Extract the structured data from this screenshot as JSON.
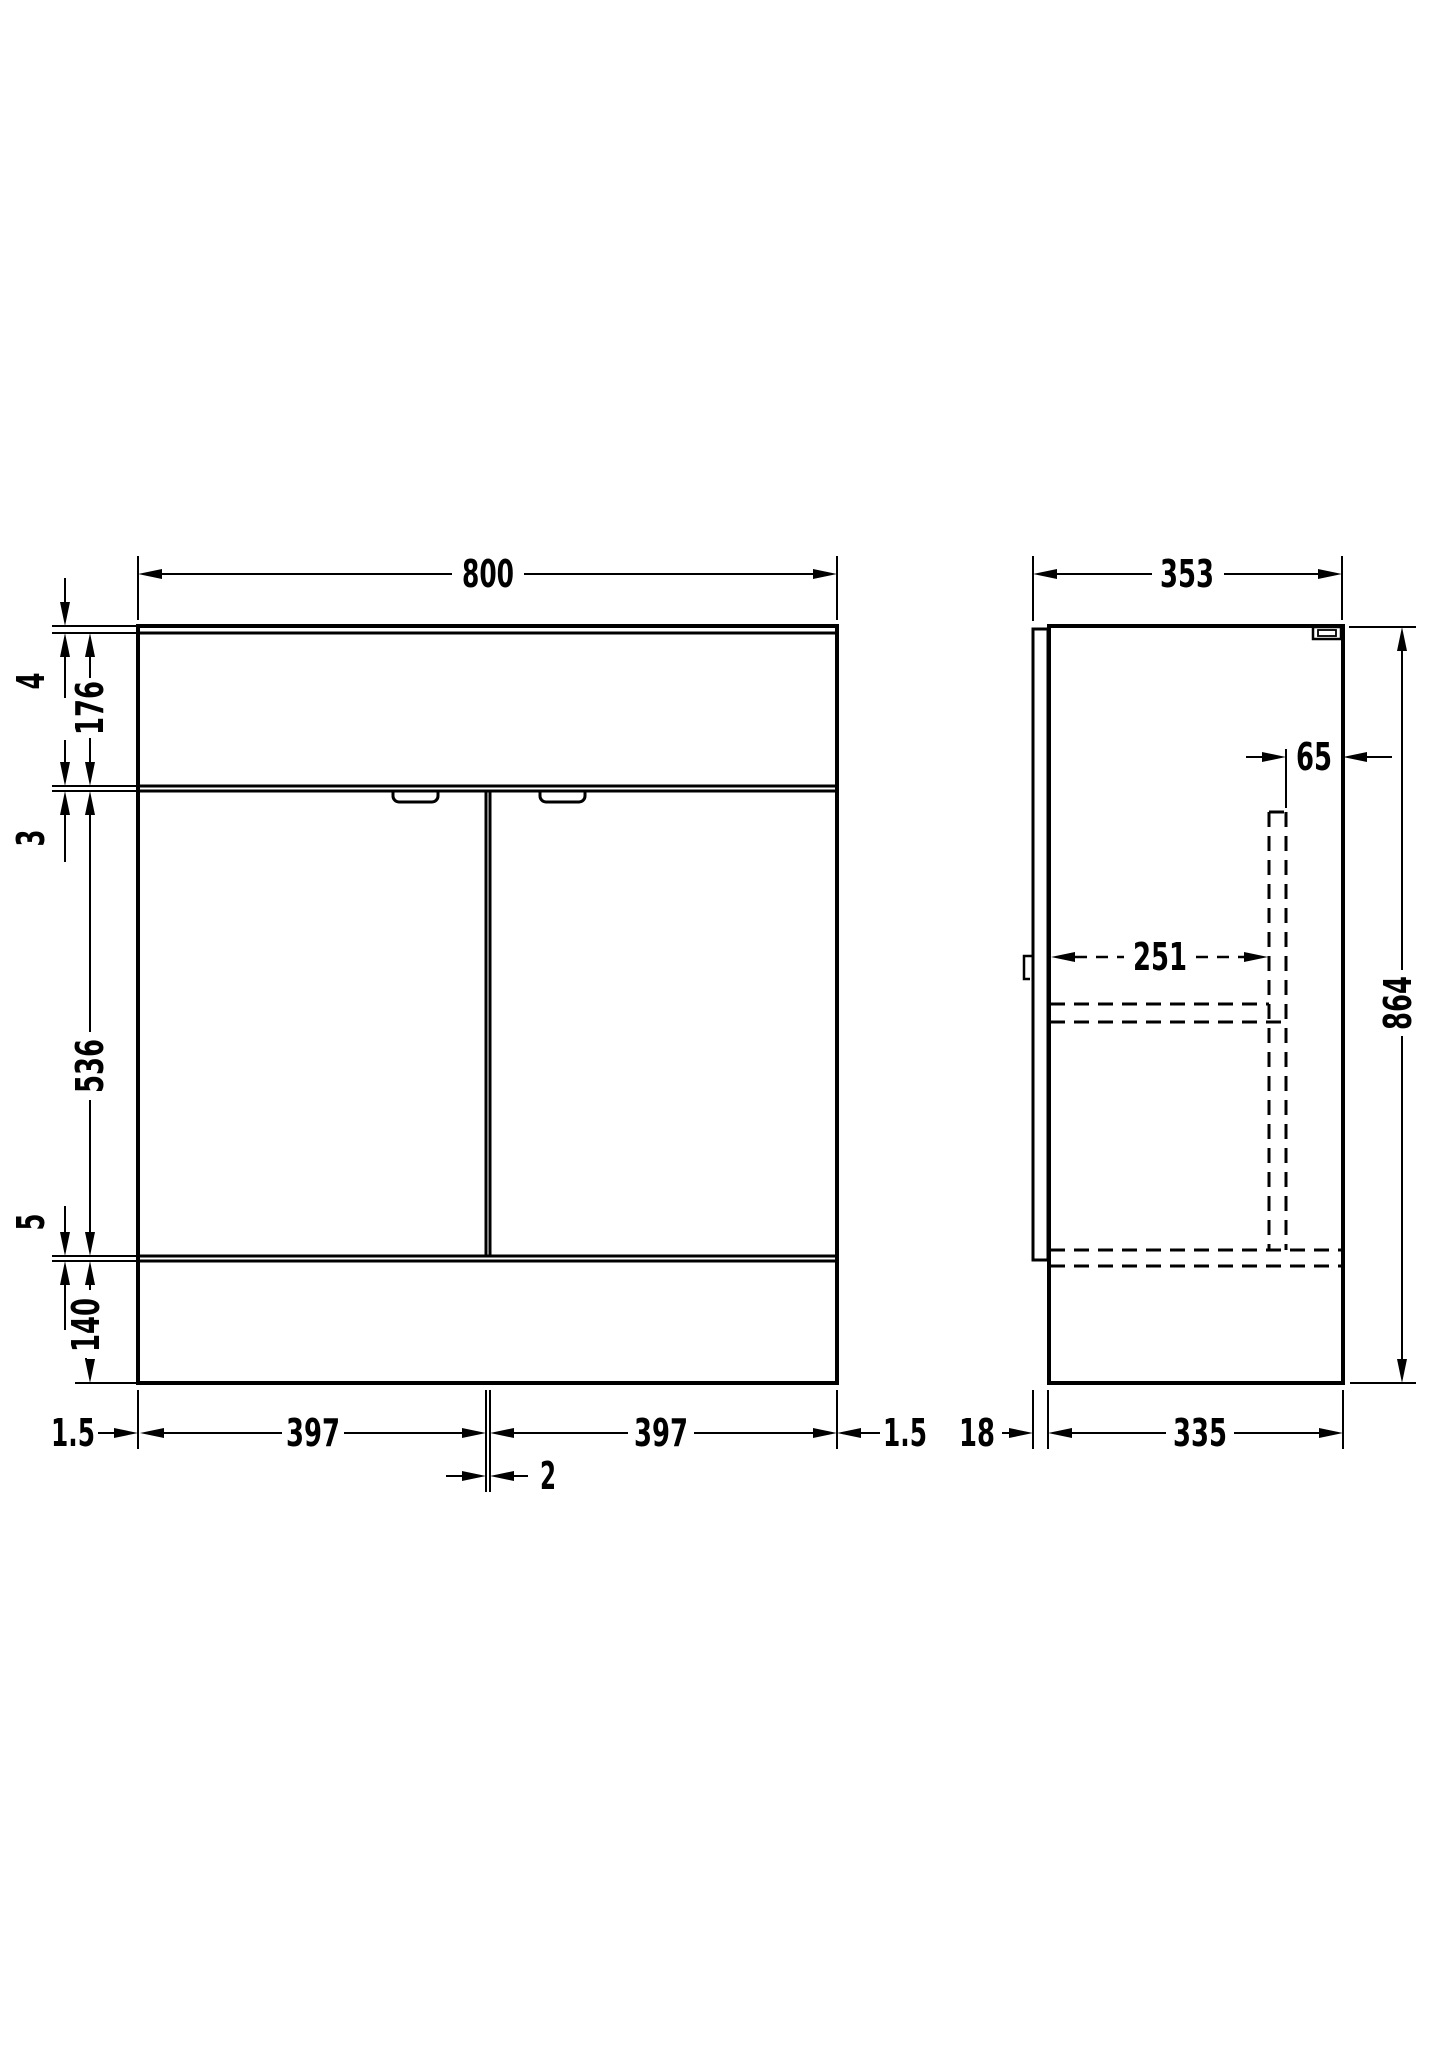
{
  "drawing_title": "vanity-unit-dimension-drawing",
  "colors": {
    "line": "#000000",
    "background": "#ffffff"
  },
  "front_view": {
    "width": "800",
    "worktop_thickness": "4",
    "upper_section_height": "176",
    "top_gap": "3",
    "door_height": "536",
    "bottom_gap": "5",
    "plinth_height": "140",
    "left_margin": "1.5",
    "left_door_width": "397",
    "center_door_gap": "2",
    "right_door_width": "397",
    "right_margin": "1.5"
  },
  "side_view": {
    "overall_depth": "353",
    "rear_service_gap": "65",
    "internal_clear_depth": "251",
    "overall_height": "864",
    "door_thickness": "18",
    "carcass_depth": "335"
  },
  "icons": {
    "wall_fixing_bracket": "wall-fixing-bracket-icon",
    "door_handle": "recessed-door-handle"
  }
}
